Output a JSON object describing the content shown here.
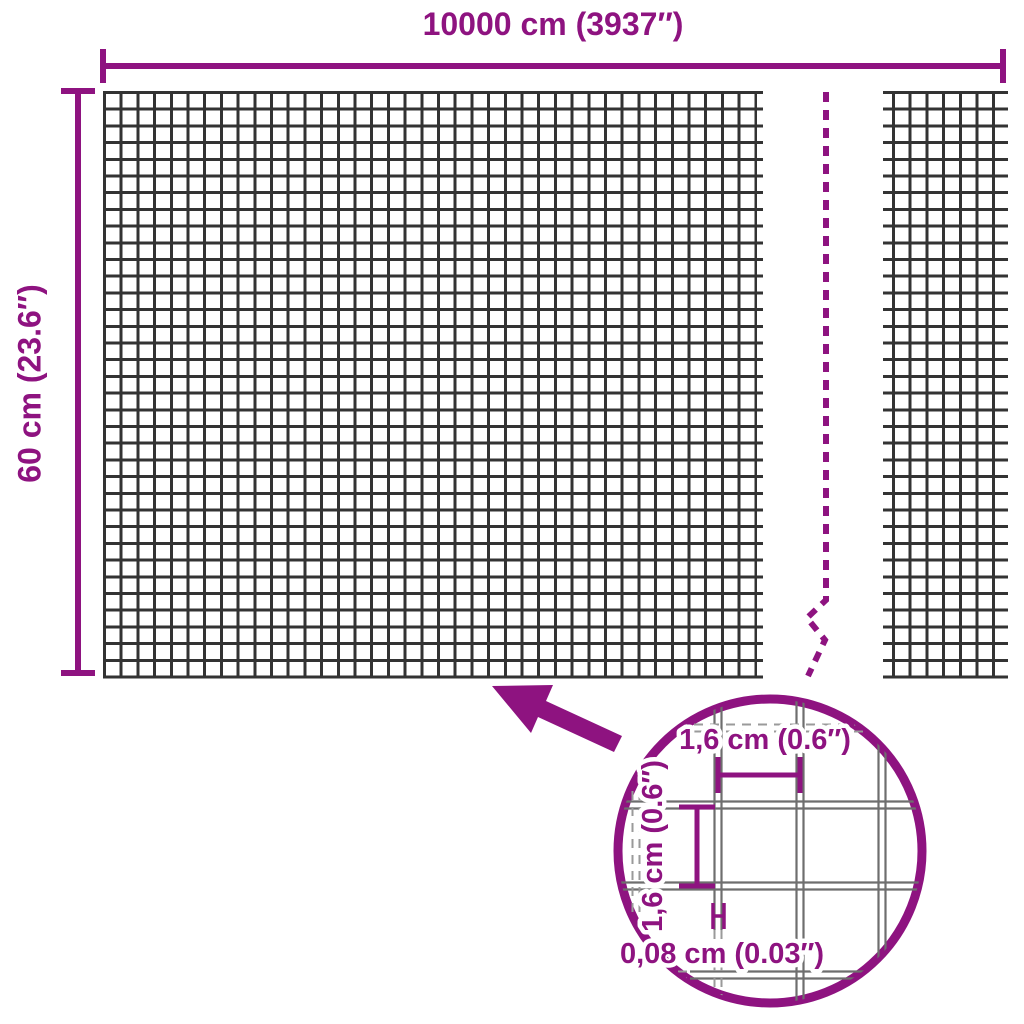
{
  "colors": {
    "accent": "#8E1380",
    "mesh": "#333333",
    "wire": "#6E6E6E",
    "wire_dash": "#9A9A9A"
  },
  "dimensions": {
    "width_label": "10000 cm (3937″)",
    "height_label": "60 cm (23.6″)"
  },
  "detail": {
    "cell_width_label": "1,6 cm (0.6″)",
    "cell_height_label": "1,6 cm (0.6″)",
    "wire_thickness_label": "0,08 cm (0.03″)"
  }
}
